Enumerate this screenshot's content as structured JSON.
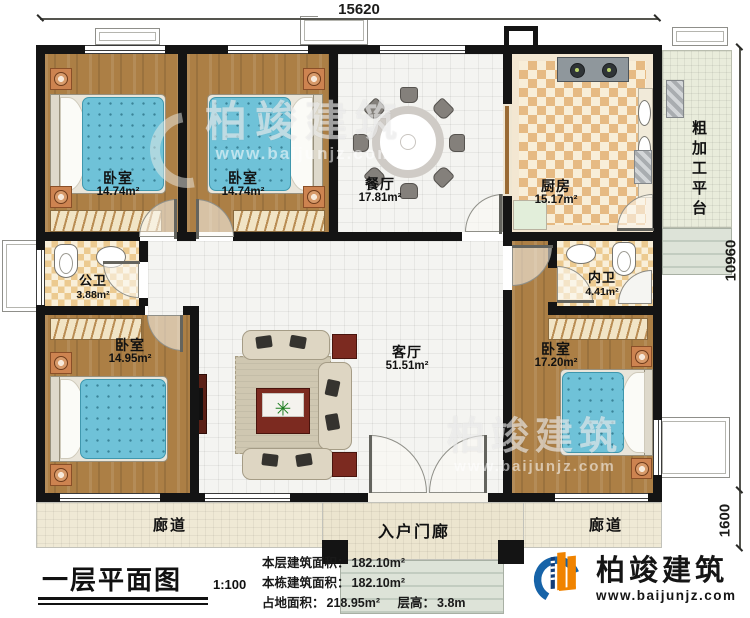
{
  "dimensions": {
    "top": "15620",
    "right_upper": "10960",
    "right_lower": "1600"
  },
  "rooms": {
    "bedroom_tl": {
      "name": "卧室",
      "area": "14.74m²"
    },
    "bedroom_tm": {
      "name": "卧室",
      "area": "14.74m²"
    },
    "dining": {
      "name": "餐厅",
      "area": "17.81m²"
    },
    "kitchen": {
      "name": "厨房",
      "area": "15.17m²"
    },
    "platform": {
      "name": "粗加工平台"
    },
    "public_bath": {
      "name": "公卫",
      "area": "3.88m²"
    },
    "bedroom_bl": {
      "name": "卧室",
      "area": "14.95m²"
    },
    "living": {
      "name": "客厅",
      "area": "51.51m²"
    },
    "ensuite_bath": {
      "name": "内卫",
      "area": "4.41m²"
    },
    "bedroom_br": {
      "name": "卧室",
      "area": "17.20m²"
    },
    "corridor_left": {
      "name": "廊道"
    },
    "corridor_right": {
      "name": "廊道"
    },
    "entry_porch": {
      "name": "入户门廊"
    }
  },
  "title_block": {
    "plan_title": "一层平面图",
    "scale": "1:100",
    "stats": [
      {
        "label": "本层建筑面积：",
        "value": "182.10m²"
      },
      {
        "label": "本栋建筑面积：",
        "value": "182.10m²"
      },
      {
        "label": "占地面积：",
        "value": "218.95m²"
      },
      {
        "label": "层高：",
        "value": "3.8m"
      }
    ]
  },
  "brand": {
    "name": "柏竣建筑",
    "website": "www.baijunjz.com"
  },
  "watermark": {
    "name": "柏竣建筑",
    "website": "www.baijunjz.com"
  },
  "colors": {
    "wall": "#141414",
    "wood_floor": "#ac7f45",
    "mattress": "#6fc2d8",
    "kitchen_tile": "#e6ba83",
    "logo_blue": "#1663a8",
    "logo_orange": "#f08300"
  }
}
